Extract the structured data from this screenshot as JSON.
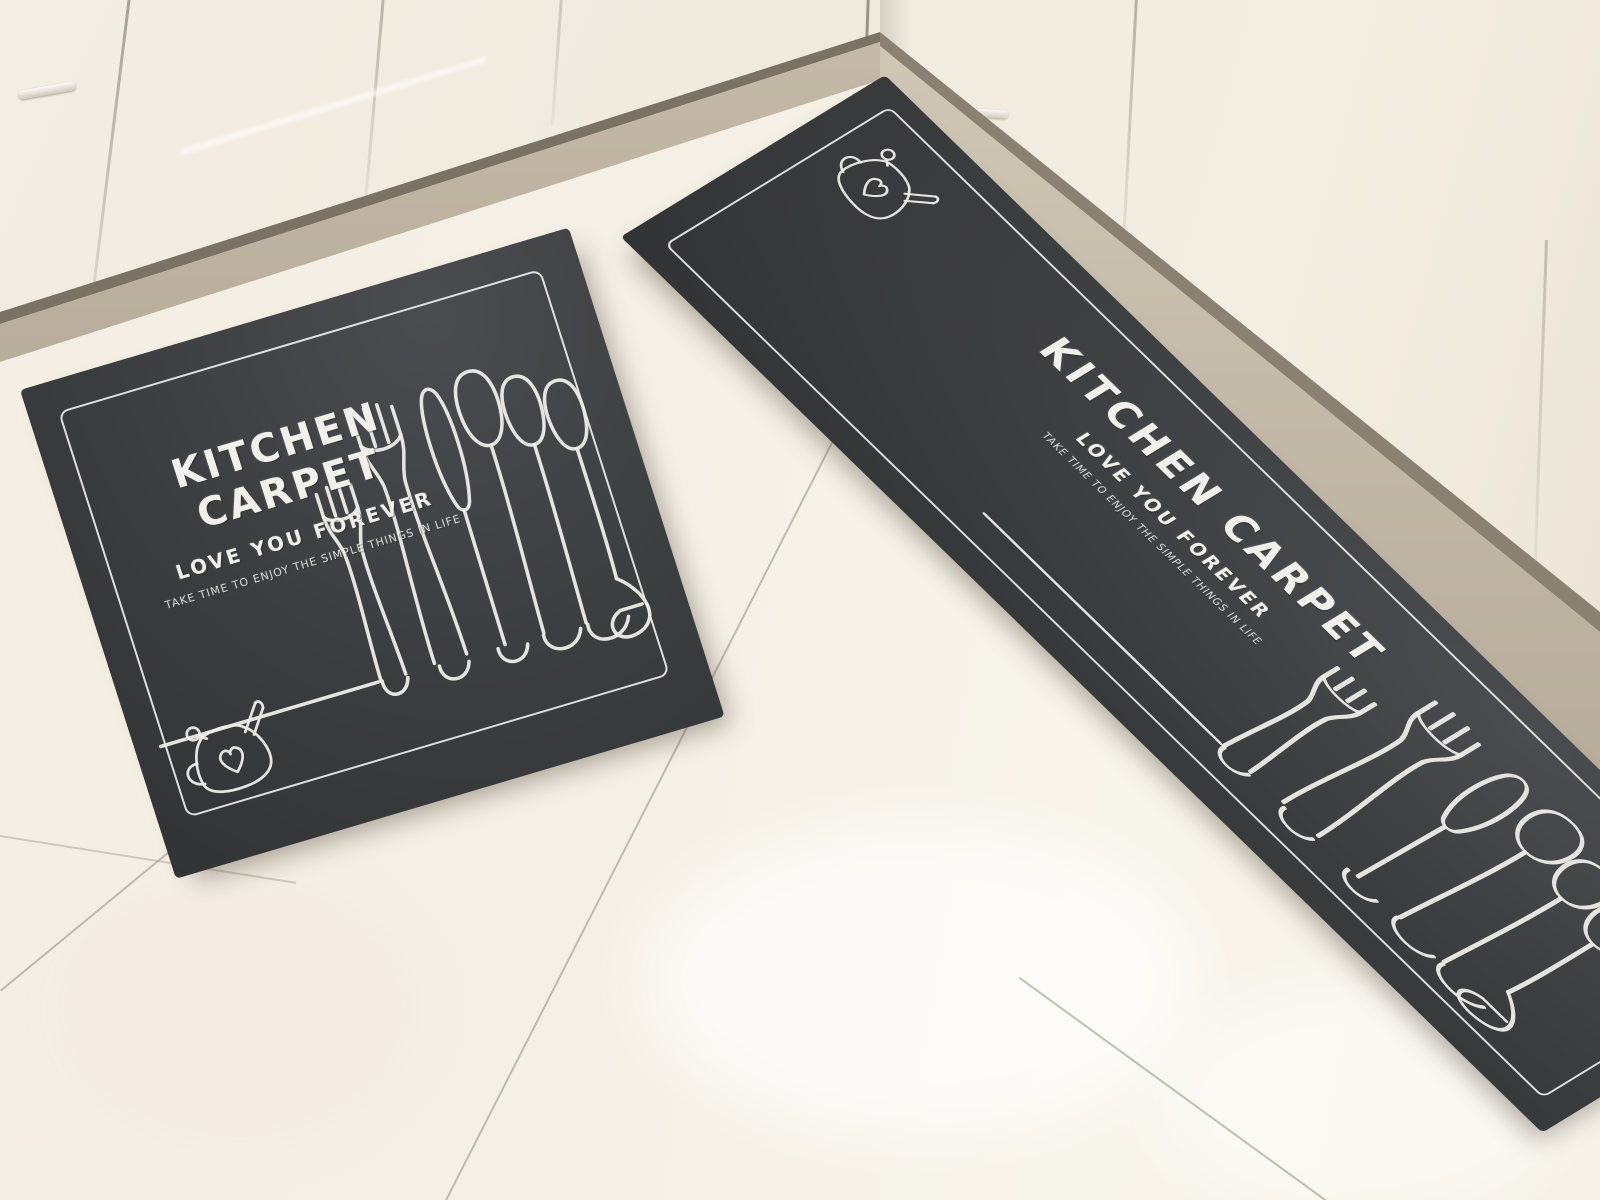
{
  "scene": {
    "left_mat": {
      "title": "KITCHEN CARPET",
      "subtitle": "LOVE YOU FOREVER",
      "tagline": "TAKE TIME TO ENJOY THE SIMPLE THINGS IN LIFE"
    },
    "right_mat": {
      "title": "KITCHEN CARPET",
      "subtitle": "LOVE YOU FOREVER",
      "tagline": "TAKE TIME TO ENJOY THE SIMPLE THINGS IN LIFE"
    },
    "icons": {
      "teapot": "teapot-with-heart-line-drawing",
      "cutlery": "forks-knife-spoons-line-drawing"
    },
    "colors": {
      "mat": "#3c3d3f",
      "mat_print": "#f0efec",
      "floor_tile": "#f5f0e6",
      "cabinet": "#f1ebdf",
      "baseboard": "#b0a694"
    }
  }
}
